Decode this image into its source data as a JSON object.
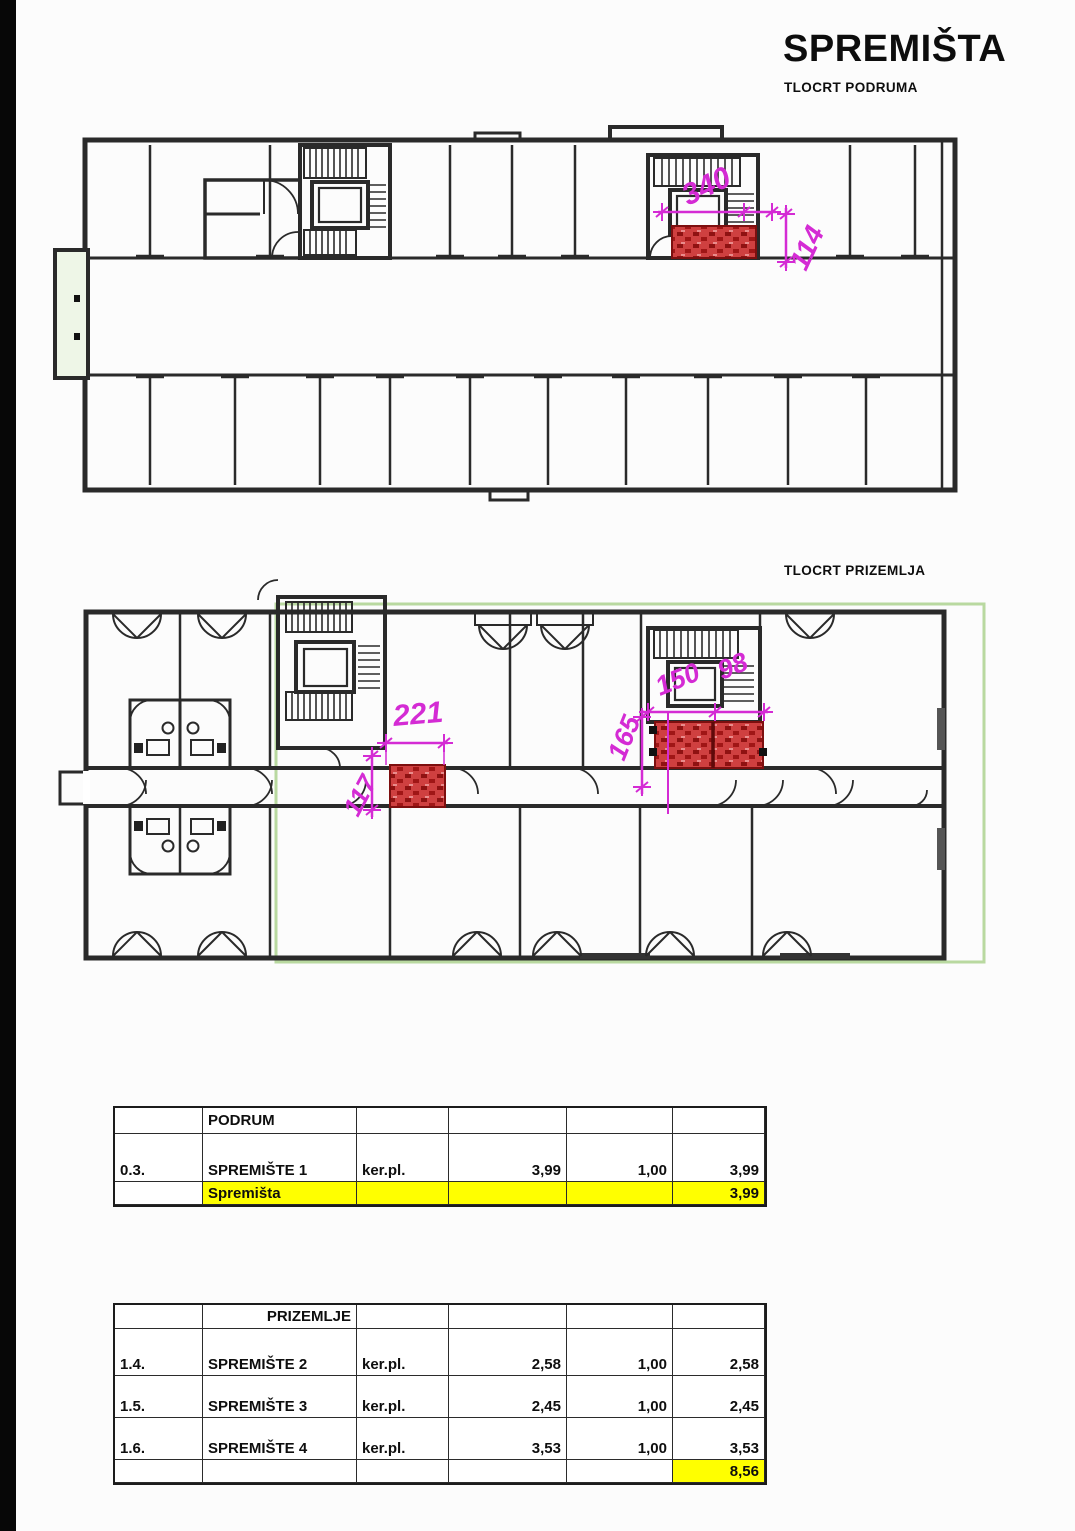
{
  "document": {
    "title": "SPREMIŠTA",
    "basement_label": "TLOCRT PODRUMA",
    "ground_label": "TLOCRT PRIZEMLJA"
  },
  "basement_plan": {
    "description": "Basement floor plan with highlighted storage room next to stair/elevator core",
    "dimensions": {
      "w": "340",
      "d": "114"
    }
  },
  "ground_plan": {
    "description": "Ground floor plan with highlighted storage rooms next to stair/elevator cores",
    "dimensions": {
      "sp2_w": "221",
      "sp2_d": "117",
      "sp34_d": "165",
      "sp3_w": "150",
      "sp4_w": "98"
    }
  },
  "podrum_table": {
    "group_header": "PODRUM",
    "rows": [
      {
        "id": "0.3.",
        "name": "SPREMIŠTE 1",
        "finish": "ker.pl.",
        "area": "3,99",
        "coef": "1,00",
        "total": "3,99"
      }
    ],
    "summary": {
      "label": "Spremišta",
      "total": "3,99"
    }
  },
  "prizemlje_table": {
    "group_header": "PRIZEMLJE",
    "rows": [
      {
        "id": "1.4.",
        "name": "SPREMIŠTE 2",
        "finish": "ker.pl.",
        "area": "2,58",
        "coef": "1,00",
        "total": "2,58"
      },
      {
        "id": "1.5.",
        "name": "SPREMIŠTE 3",
        "finish": "ker.pl.",
        "area": "2,45",
        "coef": "1,00",
        "total": "2,45"
      },
      {
        "id": "1.6.",
        "name": "SPREMIŠTE 4",
        "finish": "ker.pl.",
        "area": "3,53",
        "coef": "1,00",
        "total": "3,53"
      }
    ],
    "summary": {
      "total": "8,56"
    }
  },
  "colors": {
    "highlight_red": "#c52424",
    "highlight_red_dark": "#7d0f0f",
    "dimension_magenta": "#d42bd4",
    "plan_outline_green": "#b9d9a0",
    "summary_yellow": "#ffff00",
    "wall_ink": "#2a2a2a"
  }
}
